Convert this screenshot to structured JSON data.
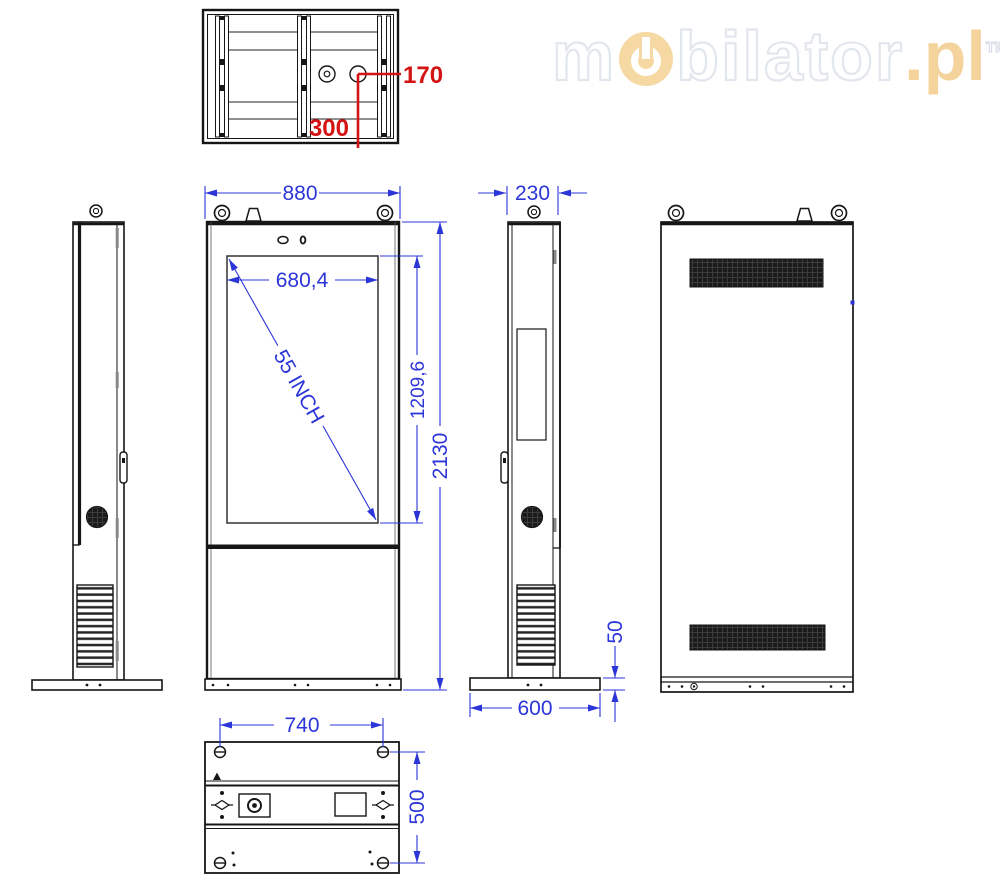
{
  "watermark": {
    "part1": "m",
    "power_icon": "power-button-icon",
    "part2": "bilator",
    "suffix": ".pl",
    "trademark": "TM"
  },
  "views": {
    "top": {
      "name": "top view",
      "offset_to_gland_x": "170",
      "offset_to_gland_y": "300"
    },
    "front": {
      "name": "front view",
      "width": "880",
      "screen_width": "680,4",
      "diagonal": "55 INCH",
      "screen_height": "1209,6",
      "height": "2130"
    },
    "side": {
      "name": "side view",
      "depth": "230",
      "base_height": "50",
      "base_depth": "600"
    },
    "bottom": {
      "name": "bottom view",
      "bolt_spacing_width": "740",
      "bolt_spacing_depth": "500"
    }
  },
  "colors": {
    "dimension_blue": "#2b35d8",
    "annotation_red": "#d41414",
    "line_black": "#161616",
    "watermark_outline": "#e2e6ed",
    "watermark_orange": "#f6d8a2"
  }
}
